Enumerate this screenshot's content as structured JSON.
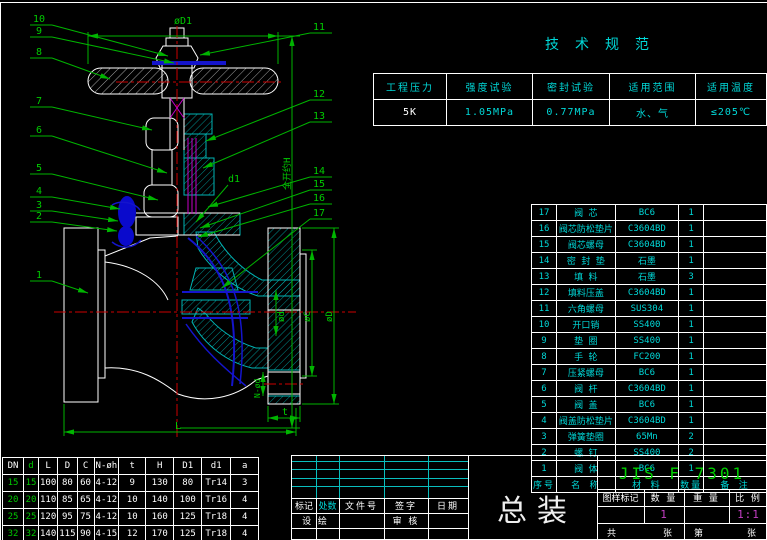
{
  "tech_spec": {
    "title": "技术规范",
    "rows": [
      [
        "工程压力",
        "强度试验",
        "密封试验",
        "适用范围",
        "适用温度"
      ],
      [
        "5K",
        "1.05MPa",
        "0.77MPa",
        "水、气",
        "≤205℃"
      ]
    ]
  },
  "bom": {
    "rows": [
      [
        "17",
        "阀 芯",
        "BC6",
        "1",
        ""
      ],
      [
        "16",
        "阀芯防松垫片",
        "C3604BD",
        "1",
        ""
      ],
      [
        "15",
        "阀芯螺母",
        "C3604BD",
        "1",
        ""
      ],
      [
        "14",
        "密 封 垫",
        "石墨",
        "1",
        ""
      ],
      [
        "13",
        "填 料",
        "石墨",
        "3",
        ""
      ],
      [
        "12",
        "填料压盖",
        "C3604BD",
        "1",
        ""
      ],
      [
        "11",
        "六角螺母",
        "SUS304",
        "1",
        ""
      ],
      [
        "10",
        "开口销",
        "SS400",
        "1",
        ""
      ],
      [
        "9",
        "垫 圈",
        "SS400",
        "1",
        ""
      ],
      [
        "8",
        "手 轮",
        "FC200",
        "1",
        ""
      ],
      [
        "7",
        "压紧螺母",
        "BC6",
        "1",
        ""
      ],
      [
        "6",
        "阀 杆",
        "C3604BD",
        "1",
        ""
      ],
      [
        "5",
        "阀 盖",
        "BC6",
        "1",
        ""
      ],
      [
        "4",
        "阀盖防松垫片",
        "C3604BD",
        "1",
        ""
      ],
      [
        "3",
        "弹簧垫圈",
        "65Mn",
        "2",
        ""
      ],
      [
        "2",
        "螺 钉",
        "SS400",
        "2",
        ""
      ],
      [
        "1",
        "阀 体",
        "BC6",
        "1",
        ""
      ]
    ],
    "footer": [
      [
        "序号",
        "名 称",
        "材 料",
        "数量",
        "备 注"
      ]
    ]
  },
  "dim_table": {
    "header": [
      [
        "DN",
        "d",
        "L",
        "D",
        "C",
        "N-øh",
        "t",
        "H",
        "D1",
        "d1",
        "a"
      ]
    ],
    "rows": [
      [
        "15",
        "15",
        "100",
        "80",
        "60",
        "4-12",
        "9",
        "130",
        "80",
        "Tr14",
        "3"
      ],
      [
        "20",
        "20",
        "110",
        "85",
        "65",
        "4-12",
        "10",
        "140",
        "100",
        "Tr16",
        "4"
      ],
      [
        "25",
        "25",
        "120",
        "95",
        "75",
        "4-12",
        "10",
        "160",
        "125",
        "Tr18",
        "4"
      ],
      [
        "32",
        "32",
        "140",
        "115",
        "90",
        "4-15",
        "12",
        "170",
        "125",
        "Tr18",
        "4"
      ],
      [
        "40",
        "40",
        "160",
        "120",
        "95",
        "4-15",
        "12",
        "190",
        "140",
        "Tr20",
        "5"
      ]
    ]
  },
  "title_block": {
    "sign_headers": [
      "标记",
      "处数",
      "文件号",
      "签字",
      "日期"
    ],
    "design_label": "设 绘",
    "check_label": "审 核",
    "drawing_title": "总装",
    "standard": "JIS F 7301",
    "info_headers": [
      "图样标记",
      "数 量",
      "重 量",
      "比 例"
    ],
    "qty_value": "1",
    "scale_value": "1:1",
    "sheet": [
      "共",
      "张",
      "第",
      "张"
    ]
  },
  "drawing": {
    "callouts_left": [
      "10",
      "9",
      "8",
      "7",
      "6",
      "5",
      "4",
      "3",
      "2",
      "1"
    ],
    "callouts_right": [
      "11",
      "12",
      "13",
      "14",
      "15",
      "16",
      "17"
    ],
    "dim_labels": {
      "d1_top": "øD1",
      "full_open": "全开约H",
      "d1": "d1",
      "dC": "øC",
      "dD": "øD",
      "dd": "ød",
      "n_holes": "N-ød",
      "t": "t",
      "L": "L"
    }
  },
  "colors": {
    "outline": "#ffffff",
    "hatch": "#00b4b4",
    "dimension": "#00b400",
    "centerline": "#cc0000",
    "flow": "#1414cc",
    "packing": "#c800c8",
    "value_magenta": "#c33fc3",
    "standard_green": "#00d000",
    "table_cyan": "#00d8d8"
  }
}
